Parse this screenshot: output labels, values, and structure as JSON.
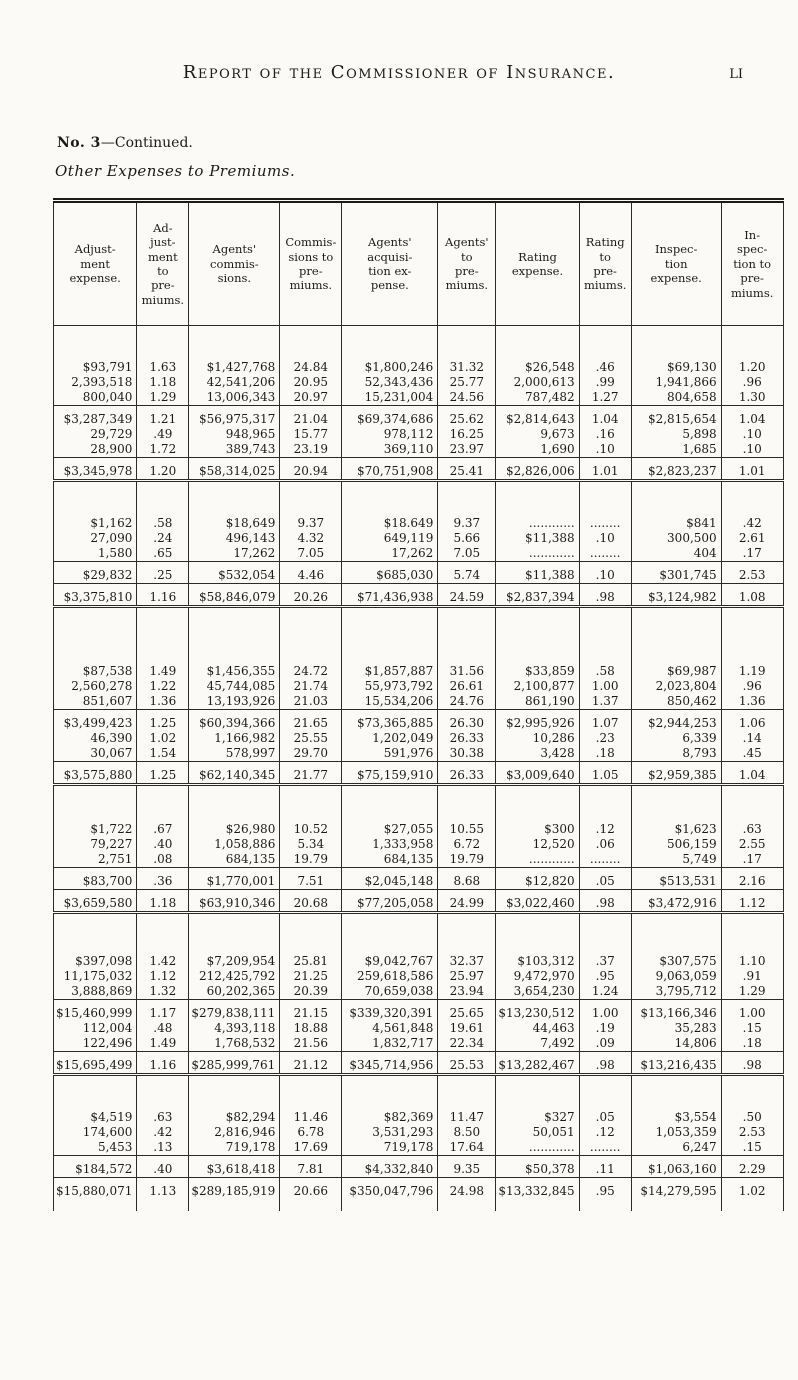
{
  "page": {
    "title": "Report of the Commissioner of Insurance.",
    "page_number": "li",
    "section_label": "No. 3",
    "section_continued": "—Continued.",
    "subtitle": "Other Expenses to Premiums."
  },
  "table": {
    "columns": [
      "Adjust-\nment\nexpense.",
      "Ad-\njust-\nment\nto\npre-\nmiums.",
      "Agents'\ncommis-\nsions.",
      "Commis-\nsions to\npre-\nmiums.",
      "Agents'\nacquisi-\ntion ex-\npense.",
      "Agents'\nto\npre-\nmiums.",
      "Rating\nexpense.",
      "Rating\nto\npre-\nmiums.",
      "Inspec-\ntion\nexpense.",
      "In-\nspec-\ntion to\npre-\nmiums."
    ],
    "col_widths": [
      76,
      52,
      90,
      62,
      96,
      58,
      78,
      52,
      90,
      62
    ],
    "rows": [
      {
        "t": "gap",
        "h": 34
      },
      {
        "t": "d",
        "c": [
          "$93,791",
          "1.63",
          "$1,427,768",
          "24.84",
          "$1,800,246",
          "31.32",
          "$26,548",
          ".46",
          "$69,130",
          "1.20"
        ]
      },
      {
        "t": "d",
        "c": [
          "2,393,518",
          "1.18",
          "42,541,206",
          "20.95",
          "52,343,436",
          "25.77",
          "2,000,613",
          ".99",
          "1,941,866",
          ".96"
        ]
      },
      {
        "t": "d",
        "c": [
          "800,040",
          "1.29",
          "13,006,343",
          "20.97",
          "15,231,004",
          "24.56",
          "787,482",
          "1.27",
          "804,658",
          "1.30"
        ]
      },
      {
        "t": "r"
      },
      {
        "t": "d",
        "c": [
          "$3,287,349",
          "1.21",
          "$56,975,317",
          "21.04",
          "$69,374,686",
          "25.62",
          "$2,814,643",
          "1.04",
          "$2,815,654",
          "1.04"
        ]
      },
      {
        "t": "d",
        "c": [
          "29,729",
          ".49",
          "948,965",
          "15.77",
          "978,112",
          "16.25",
          "9,673",
          ".16",
          "5,898",
          ".10"
        ]
      },
      {
        "t": "d",
        "c": [
          "28,900",
          "1.72",
          "389,743",
          "23.19",
          "369,110",
          "23.97",
          "1,690",
          ".10",
          "1,685",
          ".10"
        ]
      },
      {
        "t": "r"
      },
      {
        "t": "d",
        "c": [
          "$3,345,978",
          "1.20",
          "$58,314,025",
          "20.94",
          "$70,751,908",
          "25.41",
          "$2,826,006",
          "1.01",
          "$2,823,237",
          "1.01"
        ]
      },
      {
        "t": "dr"
      },
      {
        "t": "gap",
        "h": 26
      },
      {
        "t": "d",
        "c": [
          "$1,162",
          ".58",
          "$18,649",
          "9.37",
          "$18.649",
          "9.37",
          "............",
          "........",
          "$841",
          ".42"
        ]
      },
      {
        "t": "d",
        "c": [
          "27,090",
          ".24",
          "496,143",
          "4.32",
          "649,119",
          "5.66",
          "$11,388",
          ".10",
          "300,500",
          "2.61"
        ]
      },
      {
        "t": "d",
        "c": [
          "1,580",
          ".65",
          "17,262",
          "7.05",
          "17,262",
          "7.05",
          "............",
          "........",
          "404",
          ".17"
        ]
      },
      {
        "t": "r"
      },
      {
        "t": "d",
        "c": [
          "$29,832",
          ".25",
          "$532,054",
          "4.46",
          "$685,030",
          "5.74",
          "$11,388",
          ".10",
          "$301,745",
          "2.53"
        ]
      },
      {
        "t": "r"
      },
      {
        "t": "d",
        "c": [
          "$3,375,810",
          "1.16",
          "$58,846,079",
          "20.26",
          "$71,436,938",
          "24.59",
          "$2,837,394",
          ".98",
          "$3,124,982",
          "1.08"
        ]
      },
      {
        "t": "dr"
      },
      {
        "t": "gap",
        "h": 48
      },
      {
        "t": "d",
        "c": [
          "$87,538",
          "1.49",
          "$1,456,355",
          "24.72",
          "$1,857,887",
          "31.56",
          "$33,859",
          ".58",
          "$69,987",
          "1.19"
        ]
      },
      {
        "t": "d",
        "c": [
          "2,560,278",
          "1.22",
          "45,744,085",
          "21.74",
          "55,973,792",
          "26.61",
          "2,100,877",
          "1.00",
          "2,023,804",
          ".96"
        ]
      },
      {
        "t": "d",
        "c": [
          "851,607",
          "1.36",
          "13,193,926",
          "21.03",
          "15,534,206",
          "24.76",
          "861,190",
          "1.37",
          "850,462",
          "1.36"
        ]
      },
      {
        "t": "r"
      },
      {
        "t": "d",
        "c": [
          "$3,499,423",
          "1.25",
          "$60,394,366",
          "21.65",
          "$73,365,885",
          "26.30",
          "$2,995,926",
          "1.07",
          "$2,944,253",
          "1.06"
        ]
      },
      {
        "t": "d",
        "c": [
          "46,390",
          "1.02",
          "1,166,982",
          "25.55",
          "1,202,049",
          "26.33",
          "10,286",
          ".23",
          "6,339",
          ".14"
        ]
      },
      {
        "t": "d",
        "c": [
          "30,067",
          "1.54",
          "578,997",
          "29.70",
          "591,976",
          "30.38",
          "3,428",
          ".18",
          "8,793",
          ".45"
        ]
      },
      {
        "t": "r"
      },
      {
        "t": "d",
        "c": [
          "$3,575,880",
          "1.25",
          "$62,140,345",
          "21.77",
          "$75,159,910",
          "26.33",
          "$3,009,640",
          "1.05",
          "$2,959,385",
          "1.04"
        ]
      },
      {
        "t": "dr"
      },
      {
        "t": "gap",
        "h": 28
      },
      {
        "t": "d",
        "c": [
          "$1,722",
          ".67",
          "$26,980",
          "10.52",
          "$27,055",
          "10.55",
          "$300",
          ".12",
          "$1,623",
          ".63"
        ]
      },
      {
        "t": "d",
        "c": [
          "79,227",
          ".40",
          "1,058,886",
          "5.34",
          "1,333,958",
          "6.72",
          "12,520",
          ".06",
          "506,159",
          "2.55"
        ]
      },
      {
        "t": "d",
        "c": [
          "2,751",
          ".08",
          "684,135",
          "19.79",
          "684,135",
          "19.79",
          "............",
          "........",
          "5,749",
          ".17"
        ]
      },
      {
        "t": "r"
      },
      {
        "t": "d",
        "c": [
          "$83,700",
          ".36",
          "$1,770,001",
          "7.51",
          "$2,045,148",
          "8.68",
          "$12,820",
          ".05",
          "$513,531",
          "2.16"
        ]
      },
      {
        "t": "r"
      },
      {
        "t": "d",
        "c": [
          "$3,659,580",
          "1.18",
          "$63,910,346",
          "20.68",
          "$77,205,058",
          "24.99",
          "$3,022,460",
          ".98",
          "$3,472,916",
          "1.12"
        ]
      },
      {
        "t": "dr"
      },
      {
        "t": "gap",
        "h": 32
      },
      {
        "t": "d",
        "c": [
          "$397,098",
          "1.42",
          "$7,209,954",
          "25.81",
          "$9,042,767",
          "32.37",
          "$103,312",
          ".37",
          "$307,575",
          "1.10"
        ]
      },
      {
        "t": "d",
        "c": [
          "11,175,032",
          "1.12",
          "212,425,792",
          "21.25",
          "259,618,586",
          "25.97",
          "9,472,970",
          ".95",
          "9,063,059",
          ".91"
        ]
      },
      {
        "t": "d",
        "c": [
          "3,888,869",
          "1.32",
          "60,202,365",
          "20.39",
          "70,659,038",
          "23.94",
          "3,654,230",
          "1.24",
          "3,795,712",
          "1.29"
        ]
      },
      {
        "t": "r"
      },
      {
        "t": "d",
        "c": [
          "$15,460,999",
          "1.17",
          "$279,838,111",
          "21.15",
          "$339,320,391",
          "25.65",
          "$13,230,512",
          "1.00",
          "$13,166,346",
          "1.00"
        ]
      },
      {
        "t": "d",
        "c": [
          "112,004",
          ".48",
          "4,393,118",
          "18.88",
          "4,561,848",
          "19.61",
          "44,463",
          ".19",
          "35,283",
          ".15"
        ]
      },
      {
        "t": "d",
        "c": [
          "122,496",
          "1.49",
          "1,768,532",
          "21.56",
          "1,832,717",
          "22.34",
          "7,492",
          ".09",
          "14,806",
          ".18"
        ]
      },
      {
        "t": "r"
      },
      {
        "t": "d",
        "c": [
          "$15,695,499",
          "1.16",
          "$285,999,761",
          "21.12",
          "$345,714,956",
          "25.53",
          "$13,282,467",
          ".98",
          "$13,216,435",
          ".98"
        ]
      },
      {
        "t": "dr"
      },
      {
        "t": "gap",
        "h": 26
      },
      {
        "t": "d",
        "c": [
          "$4,519",
          ".63",
          "$82,294",
          "11.46",
          "$82,369",
          "11.47",
          "$327",
          ".05",
          "$3,554",
          ".50"
        ]
      },
      {
        "t": "d",
        "c": [
          "174,600",
          ".42",
          "2,816,946",
          "6.78",
          "3,531,293",
          "8.50",
          "50,051",
          ".12",
          "1,053,359",
          "2.53"
        ]
      },
      {
        "t": "d",
        "c": [
          "5,453",
          ".13",
          "719,178",
          "17.69",
          "719,178",
          "17.64",
          "............",
          "........",
          "6,247",
          ".15"
        ]
      },
      {
        "t": "r"
      },
      {
        "t": "d",
        "c": [
          "$184,572",
          ".40",
          "$3,618,418",
          "7.81",
          "$4,332,840",
          "9.35",
          "$50,378",
          ".11",
          "$1,063,160",
          "2.29"
        ]
      },
      {
        "t": "r"
      },
      {
        "t": "d",
        "c": [
          "$15,880,071",
          "1.13",
          "$289,185,919",
          "20.66",
          "$350,047,796",
          "24.98",
          "$13,332,845",
          ".95",
          "$14,279,595",
          "1.02"
        ]
      },
      {
        "t": "gap",
        "h": 12
      }
    ]
  }
}
